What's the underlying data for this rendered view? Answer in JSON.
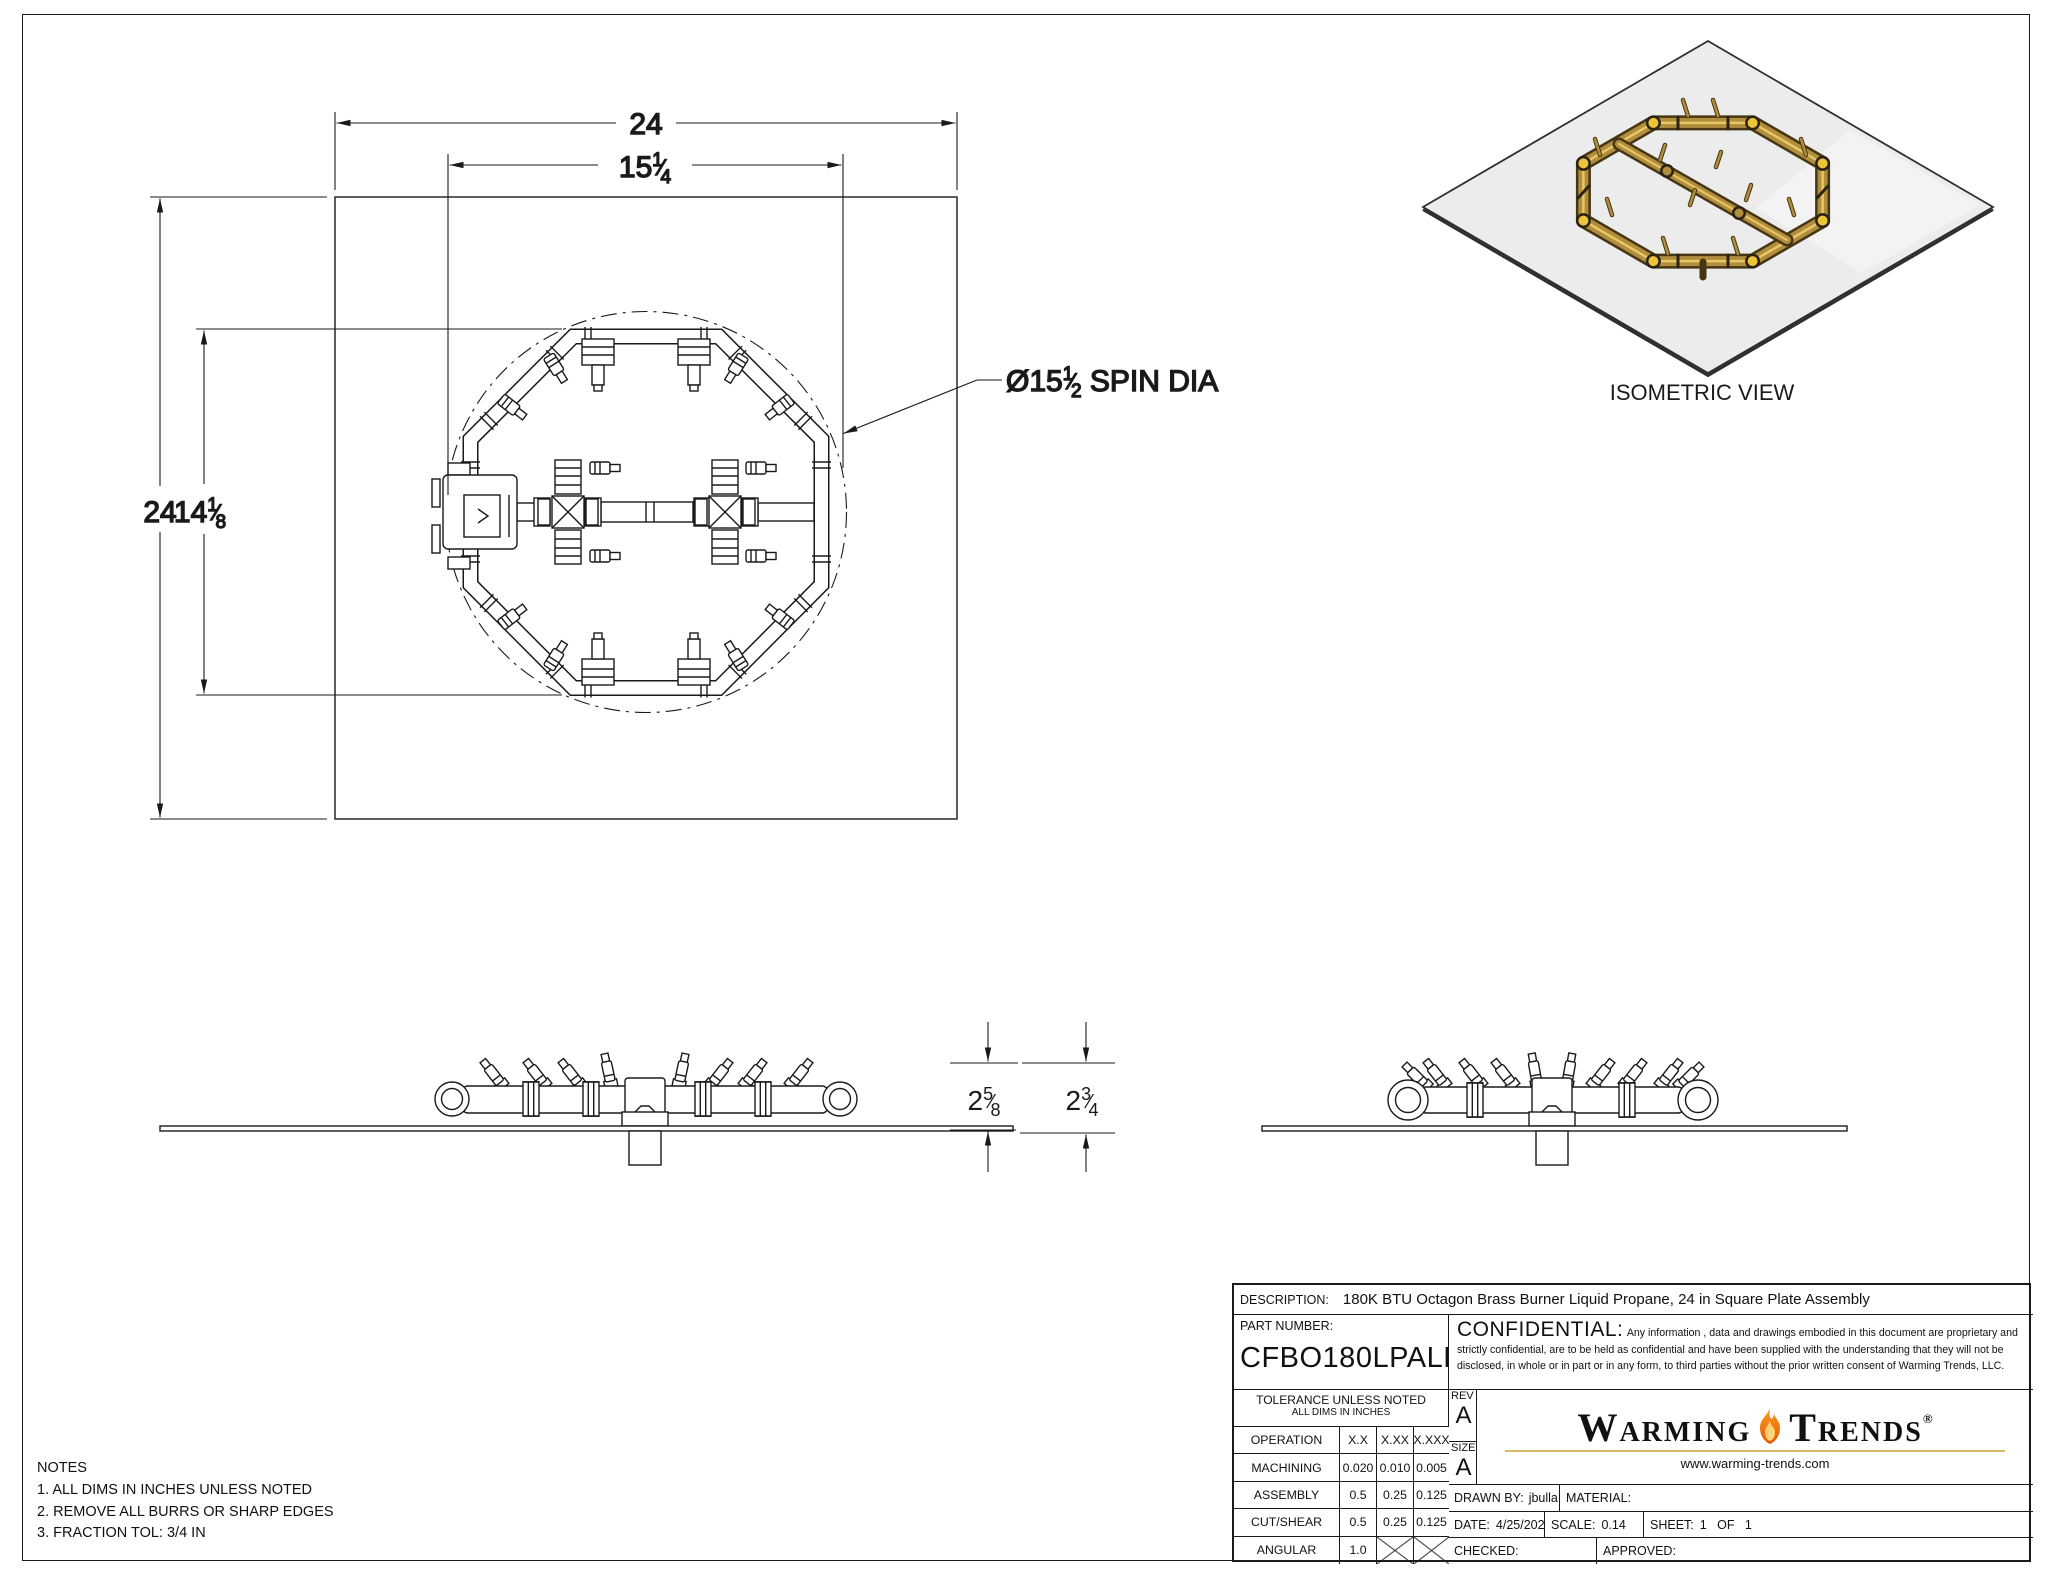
{
  "colors": {
    "line": "#1a1a1a",
    "text": "#111111",
    "brass": "#b18e3e",
    "brass_dark": "#463613",
    "brass_hi": "#e7c766",
    "accent_yellow": "#ecc437",
    "plate_gray": "#ececec",
    "plate_edge": "#2f2f2f",
    "flame_top": "#f6a021",
    "flame_bot": "#e85505",
    "gold_rule": "#d8b96a"
  },
  "plan": {
    "dim_plate_width": "24",
    "dim_plate_height": "24",
    "burner_width": {
      "whole": "15",
      "num": "1",
      "den": "4",
      "slash": "⁄"
    },
    "burner_height": {
      "whole": "14",
      "num": "1",
      "den": "8",
      "slash": "⁄"
    },
    "spin": {
      "prefix": "Ø",
      "whole": "15",
      "num": "1",
      "den": "2",
      "slash": "⁄",
      "suffix": " SPIN DIA"
    }
  },
  "side": {
    "h1": {
      "whole": "2",
      "num": "5",
      "den": "8",
      "slash": "⁄"
    },
    "h2": {
      "whole": "2",
      "num": "3",
      "den": "4",
      "slash": "⁄"
    }
  },
  "iso": {
    "label": "ISOMETRIC VIEW"
  },
  "notes": {
    "title": "NOTES",
    "items": [
      "1. ALL DIMS IN INCHES UNLESS NOTED",
      "2. REMOVE ALL BURRS OR SHARP EDGES",
      "3. FRACTION TOL: 3/4 IN"
    ]
  },
  "title_block": {
    "description_label": "DESCRIPTION:",
    "description": "180K BTU Octagon Brass Burner Liquid Propane, 24 in Square Plate Assembly",
    "part_number_label": "PART NUMBER:",
    "part_number": "CFBO180LPALPL24S",
    "confidential_label": "CONFIDENTIAL:",
    "confidential_text": "Any information , data and drawings embodied in this document are proprietary and strictly confidential, are to be held as confidential and have been supplied with the understanding that they will not be disclosed, in whole or in part or in any form, to third parties without the prior written consent of Warming Trends, LLC.",
    "tolerance_title": "TOLERANCE UNLESS NOTED",
    "tolerance_subtitle": "ALL DIMS IN INCHES",
    "table": {
      "rows": [
        [
          "OPERATION",
          "X.X",
          "X.XX",
          "X.XXX"
        ],
        [
          "MACHINING",
          "0.020",
          "0.010",
          "0.005"
        ],
        [
          "ASSEMBLY",
          "0.5",
          "0.25",
          "0.125"
        ],
        [
          "CUT/SHEAR",
          "0.5",
          "0.25",
          "0.125"
        ],
        [
          "ANGULAR",
          "1.0",
          "",
          ""
        ]
      ]
    },
    "rev_label": "REV",
    "rev": "A",
    "size_label": "SIZE",
    "size": "A",
    "drawn_by_label": "DRAWN BY:",
    "drawn_by": "jbulla",
    "material_label": "MATERIAL:",
    "material": "",
    "date_label": "DATE:",
    "date": "4/25/2022",
    "scale_label": "SCALE:",
    "scale": "0.14",
    "sheet_label": "SHEET:",
    "sheet_value": "1   OF   1",
    "checked_label": "CHECKED:",
    "checked": "",
    "approved_label": "APPROVED:",
    "approved": ""
  },
  "logo": {
    "word1_initial": "W",
    "word1_rest": "ARMING",
    "word2_initial": "T",
    "word2_rest": "RENDS",
    "registered": "®",
    "website": "www.warming-trends.com"
  }
}
